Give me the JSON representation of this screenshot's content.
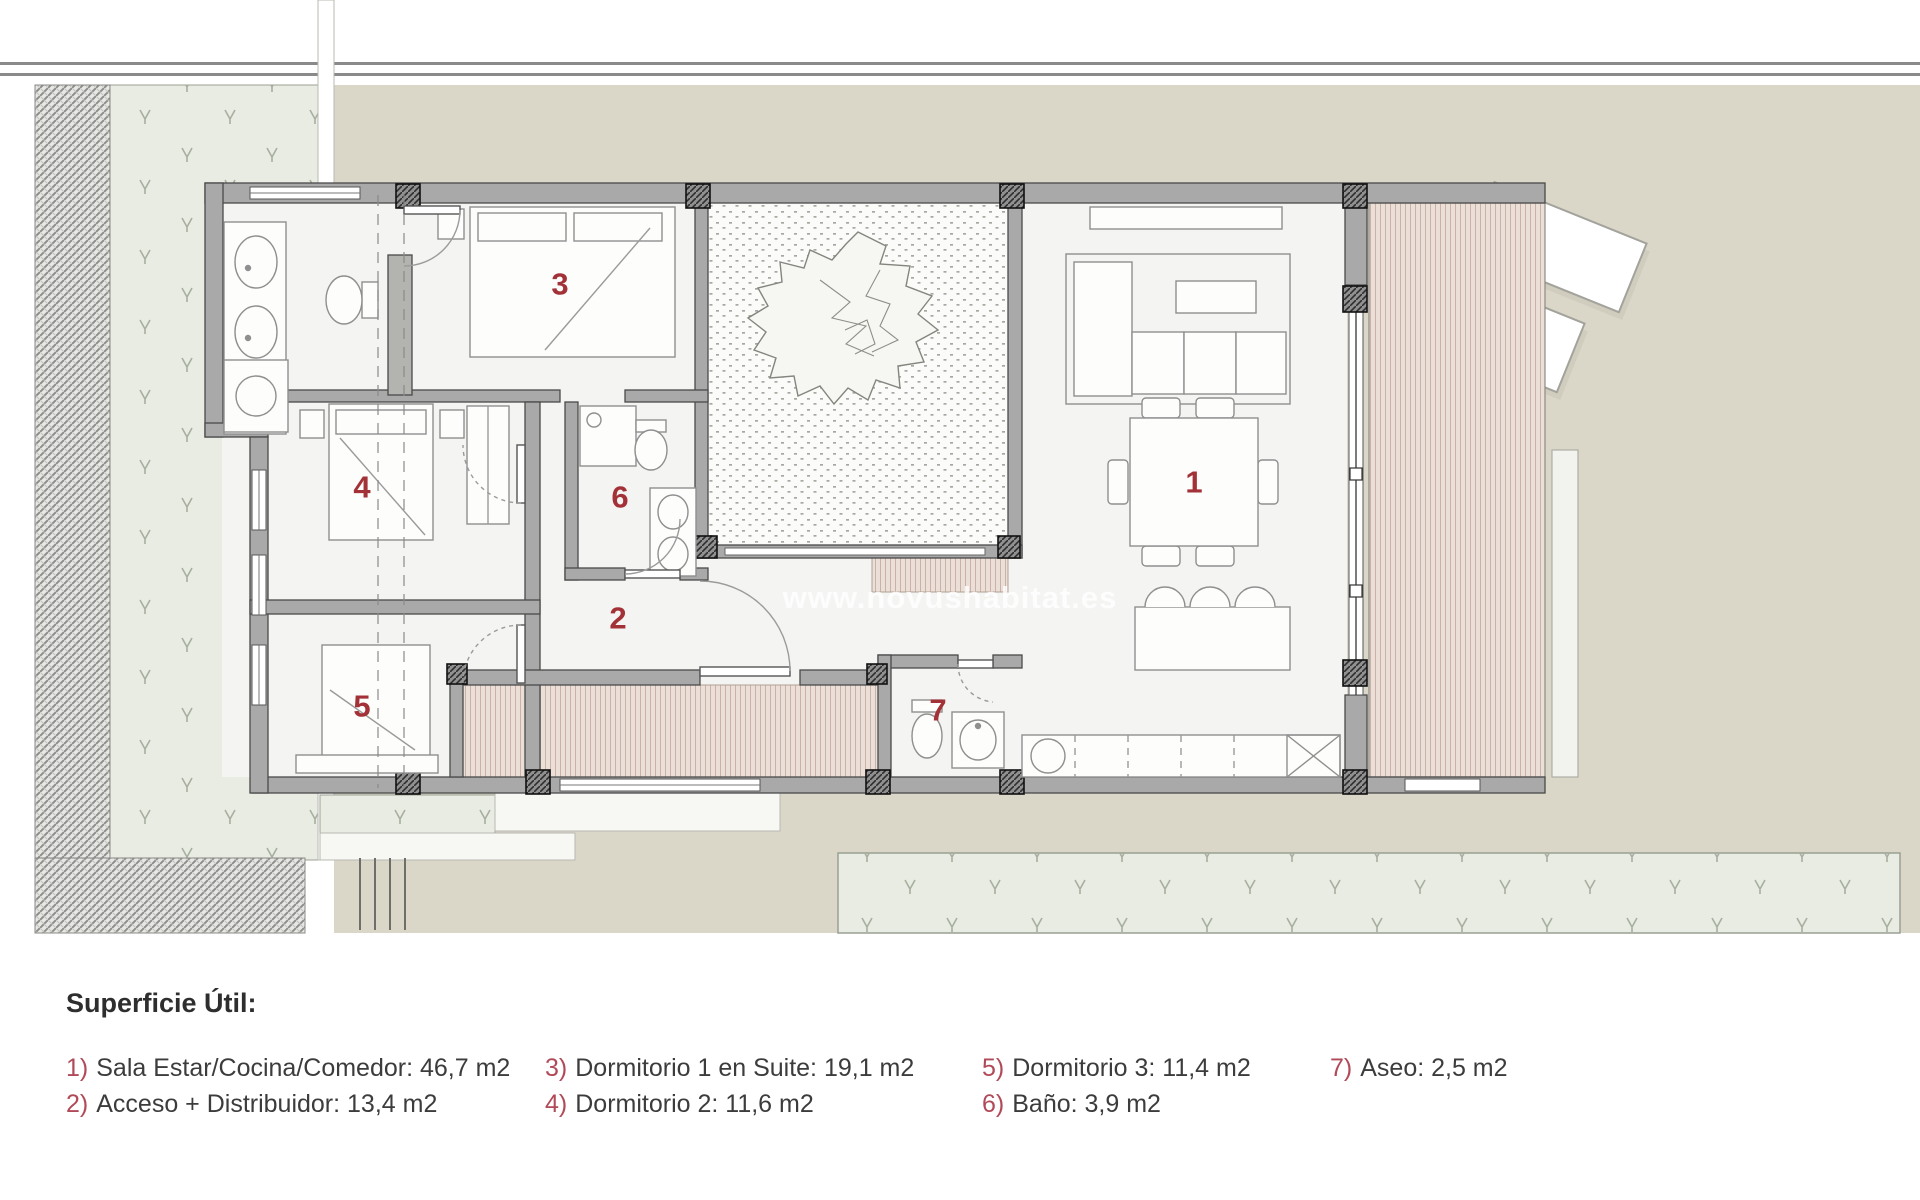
{
  "plan": {
    "watermark": "www.novushabitat.es",
    "colors": {
      "beige": "#dad7c9",
      "grass": "#e9ece3",
      "wall": "#a9a9a9",
      "wall_outline": "#4a4a4a",
      "deck": "#ebdfd7",
      "floor": "#f4f4f2",
      "label_red": "#a33238",
      "legend_red": "#b14a58"
    },
    "room_labels": [
      {
        "num": "1"
      },
      {
        "num": "2"
      },
      {
        "num": "3"
      },
      {
        "num": "4"
      },
      {
        "num": "5"
      },
      {
        "num": "6"
      },
      {
        "num": "7"
      }
    ]
  },
  "legend": {
    "title": "Superficie Útil:",
    "items": [
      {
        "num": "1)",
        "text": "Sala Estar/Cocina/Comedor: 46,7 m2"
      },
      {
        "num": "2)",
        "text": "Acceso + Distribuidor: 13,4 m2"
      },
      {
        "num": "3)",
        "text": "Dormitorio 1 en Suite: 19,1 m2"
      },
      {
        "num": "4)",
        "text": "Dormitorio 2: 11,6 m2"
      },
      {
        "num": "5)",
        "text": "Dormitorio 3: 11,4 m2"
      },
      {
        "num": "6)",
        "text": "Baño: 3,9 m2"
      },
      {
        "num": "7)",
        "text": "Aseo: 2,5 m2"
      }
    ]
  }
}
